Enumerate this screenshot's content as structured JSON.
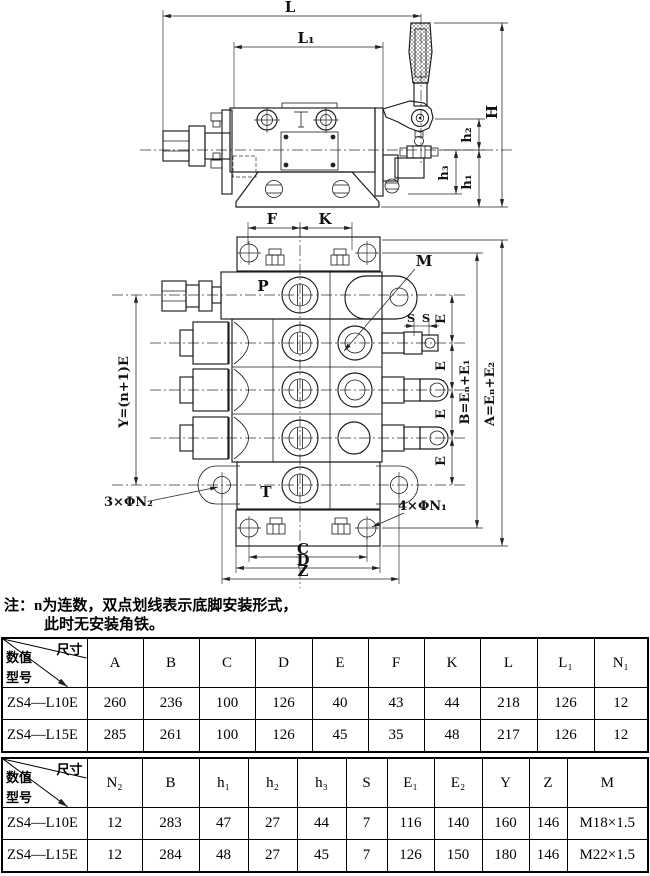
{
  "drawing": {
    "side_view": {
      "L": "L",
      "L1": "L₁",
      "H": "H",
      "h1": "h₁",
      "h2": "h₂",
      "h3": "h₃"
    },
    "plan_view": {
      "F": "F",
      "K": "K",
      "P": "P",
      "T": "T",
      "M": "M",
      "S": "S",
      "E": "E",
      "Y": "Y=(n+1)E",
      "B": "B=Eₙ+E₁",
      "A": "A=Eₙ+E₂",
      "C": "C",
      "D": "D",
      "Z": "Z",
      "N2_holes": "3×ΦN₂",
      "N1_holes": "4×ΦN₁"
    }
  },
  "note": {
    "line1": "注：n为连数，双点划线表示底脚安装形式，",
    "line2": "此时无安装角铁。"
  },
  "corner": {
    "dim": "尺寸",
    "value": "数值",
    "model": "型号"
  },
  "table1": {
    "columns": [
      "A",
      "B",
      "C",
      "D",
      "E",
      "F",
      "K",
      "L",
      "L₁",
      "N₁"
    ],
    "rows": [
      {
        "model": "ZS4—L10E",
        "values": [
          "260",
          "236",
          "100",
          "126",
          "40",
          "43",
          "44",
          "218",
          "126",
          "12"
        ]
      },
      {
        "model": "ZS4—L15E",
        "values": [
          "285",
          "261",
          "100",
          "126",
          "45",
          "35",
          "48",
          "217",
          "126",
          "12"
        ]
      }
    ]
  },
  "table2": {
    "columns": [
      "N₂",
      "B",
      "h₁",
      "h₂",
      "h₃",
      "S",
      "E₁",
      "E₂",
      "Y",
      "Z",
      "M"
    ],
    "rows": [
      {
        "model": "ZS4—L10E",
        "values": [
          "12",
          "283",
          "47",
          "27",
          "44",
          "7",
          "116",
          "140",
          "160",
          "146",
          "M18×1.5"
        ]
      },
      {
        "model": "ZS4—L15E",
        "values": [
          "12",
          "284",
          "48",
          "27",
          "45",
          "7",
          "126",
          "150",
          "180",
          "146",
          "M22×1.5"
        ]
      }
    ]
  }
}
